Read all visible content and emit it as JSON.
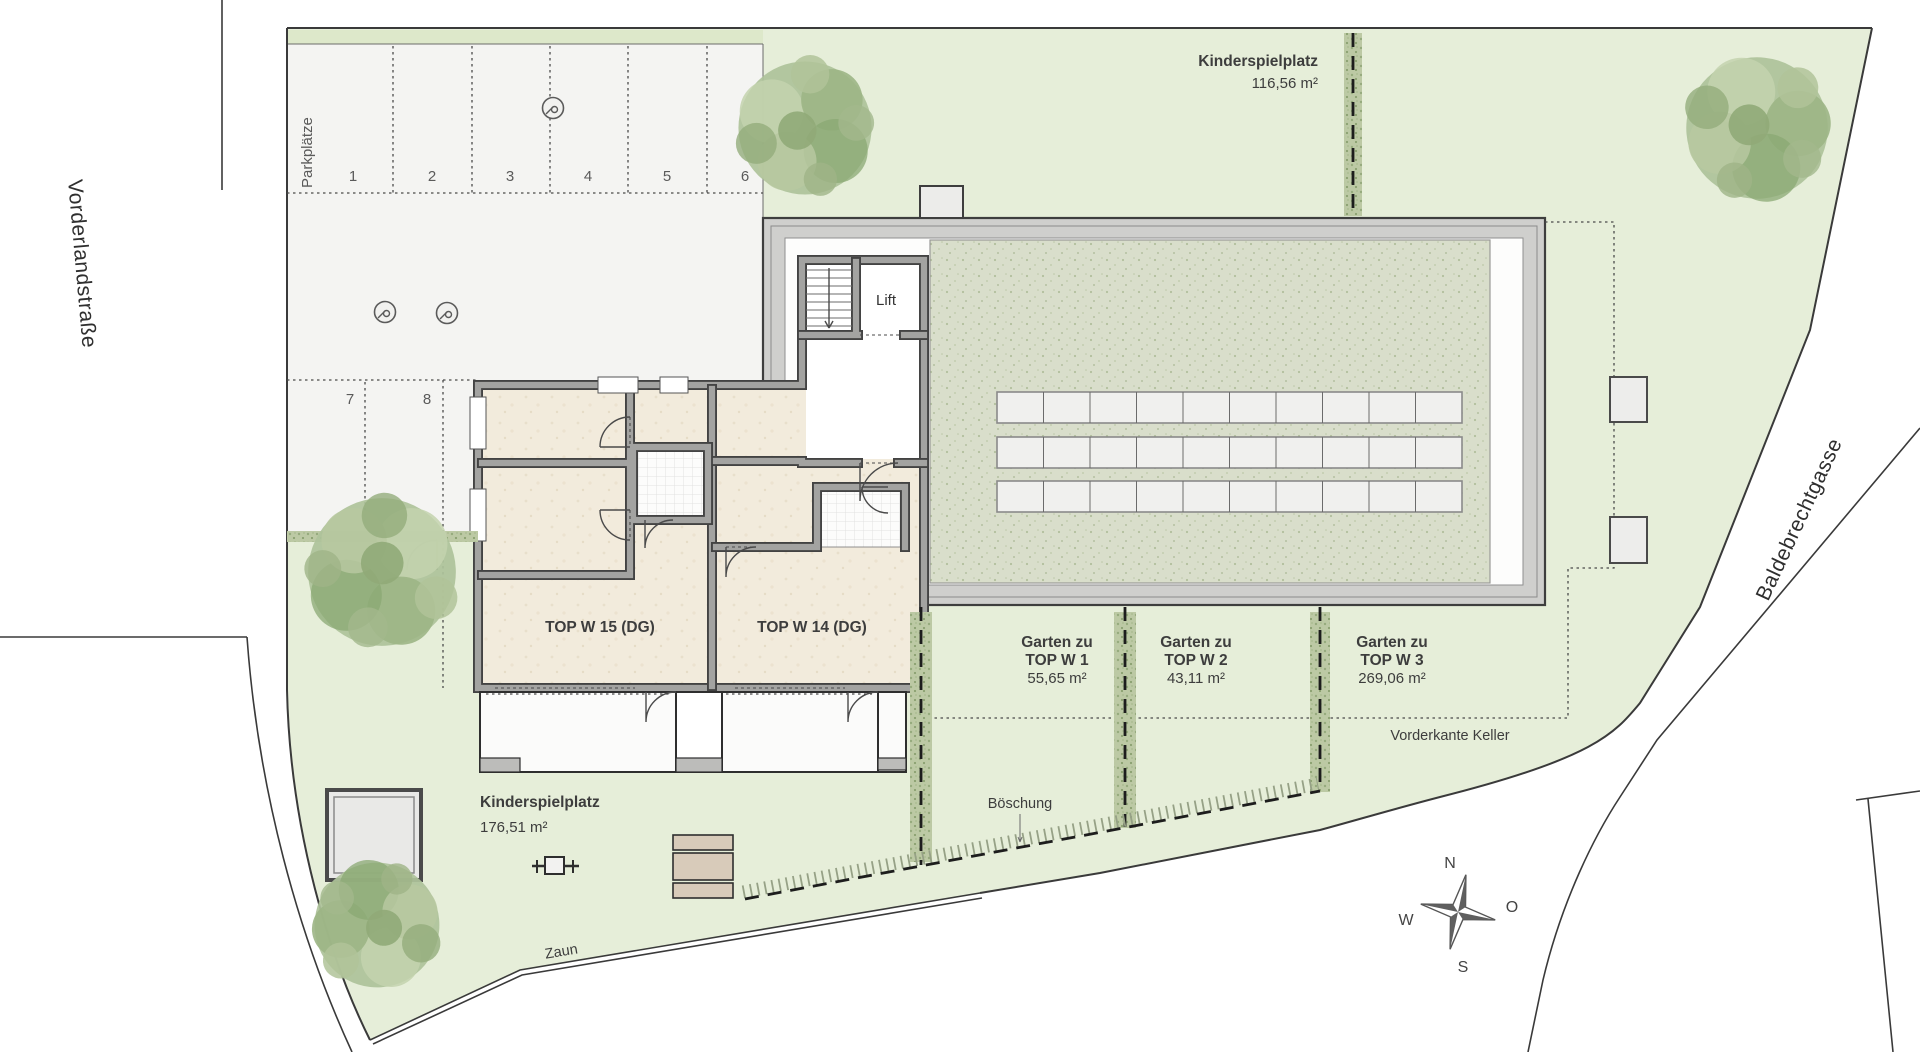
{
  "streets": {
    "left": "Vorderlandstraße",
    "right": "Baldebrechtgasse"
  },
  "parking": {
    "label": "Parkplätze",
    "spaces": [
      "1",
      "2",
      "3",
      "4",
      "5",
      "6",
      "7",
      "8"
    ]
  },
  "building": {
    "lift": "Lift",
    "unit_left": "TOP W 15 (DG)",
    "unit_right": "TOP W 14 (DG)"
  },
  "playground_top": {
    "name": "Kinderspielplatz",
    "area": "116,56 m²"
  },
  "playground_bottom": {
    "name": "Kinderspielplatz",
    "area": "176,51 m²"
  },
  "gardens": [
    {
      "prefix": "Garten zu",
      "unit": "TOP W 1",
      "area": "55,65 m²"
    },
    {
      "prefix": "Garten zu",
      "unit": "TOP W 2",
      "area": "43,11 m²"
    },
    {
      "prefix": "Garten zu",
      "unit": "TOP W 3",
      "area": "269,06 m²"
    }
  ],
  "annotations": {
    "basement_edge": "Vorderkante Keller",
    "slope": "Böschung",
    "fence": "Zaun"
  },
  "compass": {
    "north": "N",
    "east": "O",
    "south": "S",
    "west": "W"
  },
  "colors": {
    "site_green": "#e6eed9",
    "lot_gray": "#f4f4f2",
    "roof_band": "#cfcfcd",
    "roof_texture": "#d9decb",
    "hedge_green": "#b9c9a2",
    "room_beige": "#f2ebdc",
    "bench_tan": "#d8cbba",
    "text": "#3d3d3d"
  }
}
